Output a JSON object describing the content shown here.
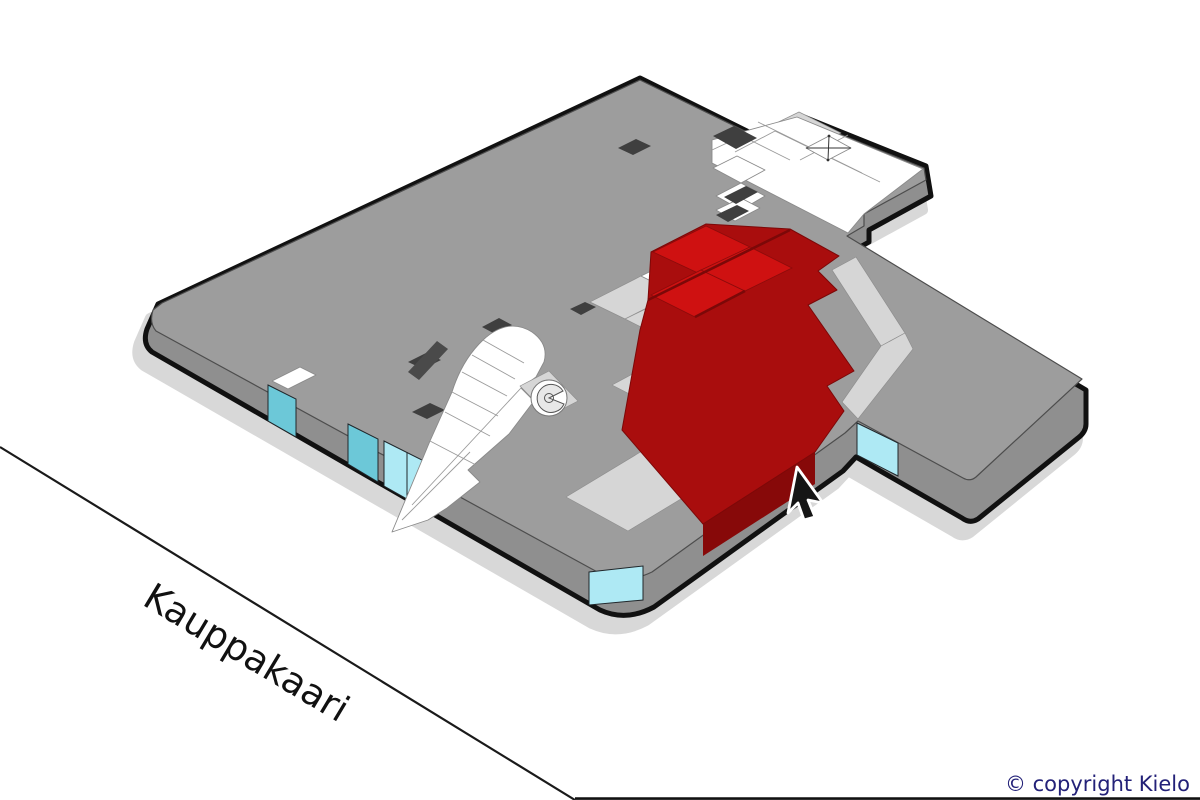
{
  "street": {
    "label": "Kauppakaari"
  },
  "footer": {
    "copyright": "© copyright Kielo"
  },
  "unit": {
    "status": "highlighted",
    "color": "#a90d0d"
  },
  "icons": {
    "cursor": "pointer-arrow",
    "elevator_shaft": "x-box",
    "spiral_ramp": "spiral"
  },
  "colors": {
    "background": "#ffffff",
    "outline": "#111111",
    "roof": "#9d9d9d",
    "side": "#8f8f8f",
    "shadow": "#d8d8d8",
    "room-white": "#ffffff",
    "room-light": "#d6d6d6",
    "red-top": "#a90d0d",
    "red-bright": "#cf1111",
    "red-side": "#870909",
    "window-cyan": "#aee9f4",
    "window-teal": "#6cc8d8",
    "street-line": "#1a1a1a",
    "label-text": "#111111",
    "copyright-text": "#232178"
  }
}
